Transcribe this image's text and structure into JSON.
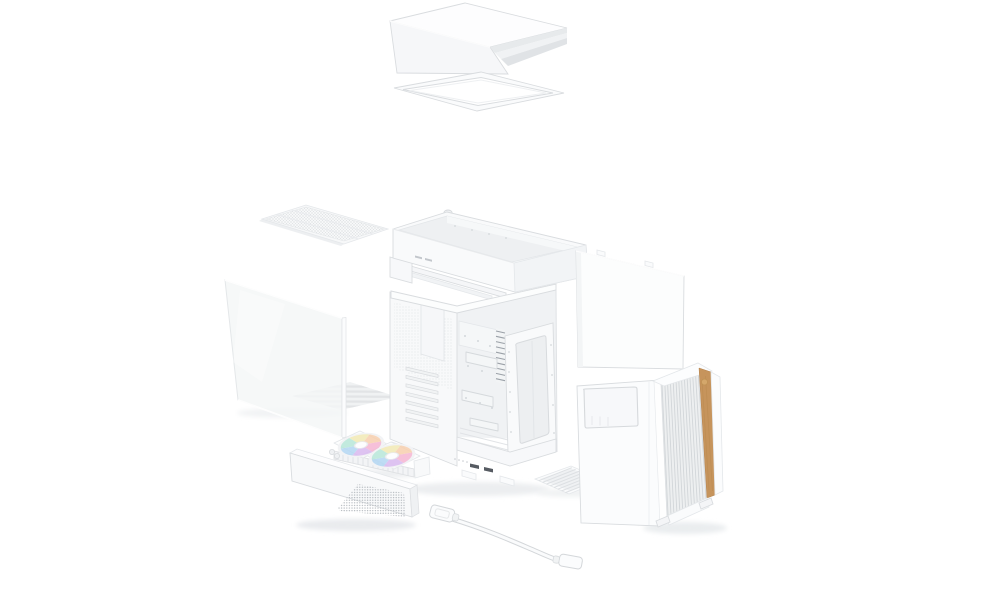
{
  "scene": {
    "description": "Exploded-view product render of a white mid-tower PC case with a wood-accent mesh front panel, on a plain white background. No text is visible in the image.",
    "background": "#ffffff",
    "parts": [
      {
        "id": "top-cover",
        "label": "top cover panel"
      },
      {
        "id": "top-filter-frame",
        "label": "top filter frame"
      },
      {
        "id": "top-mesh-filter",
        "label": "flat mesh filter panel"
      },
      {
        "id": "radiator-tray",
        "label": "top radiator / fan bracket tray"
      },
      {
        "id": "glass-side-panel",
        "label": "tempered glass side panel"
      },
      {
        "id": "chassis",
        "label": "main chassis frame"
      },
      {
        "id": "aio-cooler",
        "label": "liquid cooler radiator with two ARGB fans"
      },
      {
        "id": "front-bottom-cover",
        "label": "front lower mesh cover bar"
      },
      {
        "id": "io-cable",
        "label": "white accessory cable with connectors"
      },
      {
        "id": "bottom-dust-filter",
        "label": "bottom dust filter"
      },
      {
        "id": "right-side-panel",
        "label": "right steel side panel"
      },
      {
        "id": "front-panel",
        "label": "front mesh panel with wood trim strip"
      }
    ],
    "colors": {
      "white": "#fdfdfe",
      "panel": "#f8f9fa",
      "panel_shade": "#f0f1f3",
      "panel_dark": "#e3e5e8",
      "edge": "#d9dcdf",
      "interior": "#f0f2f4",
      "mesh_line": "#d2d6d9",
      "wood": "#c6945c",
      "wood_light": "#d4a76b",
      "wood_grain": "#b8884f",
      "port_dark": "#565b62",
      "fin_dark": "#9ba1a8",
      "fan_pink": "#f5b5d2",
      "fan_lavender": "#d8b9ee",
      "fan_blue": "#b3d6f2",
      "fan_mint": "#b7e6d8",
      "fan_yellow": "#f1e9b4",
      "fan_peach": "#f7cfae"
    }
  }
}
